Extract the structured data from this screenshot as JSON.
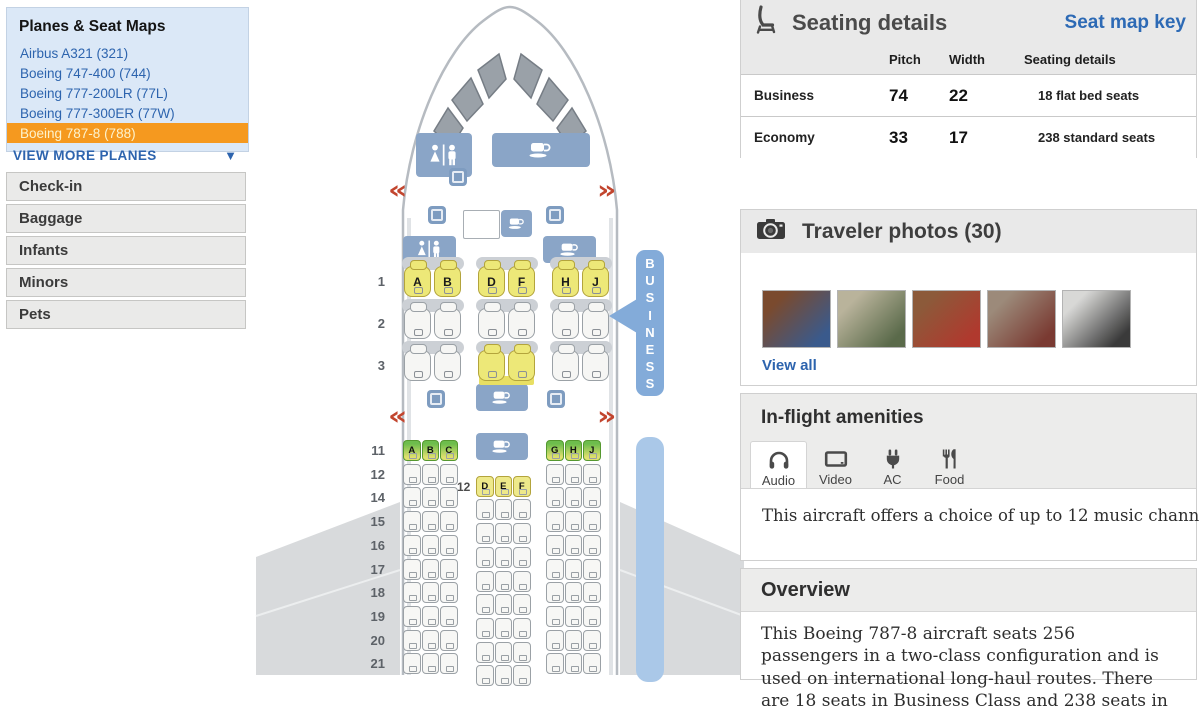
{
  "colors": {
    "accent_orange": "#f5991f",
    "link_blue": "#2d64ae",
    "panel_blue": "#8aa5c7",
    "arrow_blue": "#83abd9",
    "economy_bar_blue": "#aac8e8",
    "exit_red": "#c2452e",
    "seat_yellow": "#ede878",
    "seat_green": "#6dbd4c"
  },
  "sidebar": {
    "title": "Planes & Seat Maps",
    "planes": [
      {
        "label": "Airbus A321 (321)",
        "selected": false
      },
      {
        "label": "Boeing 747-400 (744)",
        "selected": false
      },
      {
        "label": "Boeing 777-200LR (77L)",
        "selected": false
      },
      {
        "label": "Boeing 777-300ER (77W)",
        "selected": false
      },
      {
        "label": "Boeing 787-8 (788)",
        "selected": true
      }
    ],
    "view_more": "VIEW MORE PLANES",
    "menu": [
      "Check-in",
      "Baggage",
      "Infants",
      "Minors",
      "Pets"
    ]
  },
  "seating_details": {
    "title": "Seating details",
    "key_link": "Seat map key",
    "columns": [
      "Pitch",
      "Width",
      "Seating details"
    ],
    "rows": [
      {
        "cabin": "Business",
        "pitch": "74",
        "width": "22",
        "details": "18 flat bed seats"
      },
      {
        "cabin": "Economy",
        "pitch": "33",
        "width": "17",
        "details": "238 standard seats"
      }
    ]
  },
  "traveler_photos": {
    "title": "Traveler photos (30)",
    "view_all": "View all",
    "photos": [
      {
        "c1": "#7a4a2e",
        "c2": "#3a5a8c"
      },
      {
        "c1": "#b9b39b",
        "c2": "#5a6a4a"
      },
      {
        "c1": "#8c5a3a",
        "c2": "#b0392e"
      },
      {
        "c1": "#9c8a7a",
        "c2": "#7a3a32"
      },
      {
        "c1": "#d8d8d6",
        "c2": "#3a3a3a"
      }
    ]
  },
  "amenities": {
    "title": "In-flight amenities",
    "tabs": [
      {
        "label": "Audio",
        "icon": "headphones",
        "selected": true
      },
      {
        "label": "Video",
        "icon": "video",
        "selected": false
      },
      {
        "label": "AC Power",
        "icon": "ac-power",
        "selected": false
      },
      {
        "label": "Food",
        "icon": "food",
        "selected": false
      }
    ],
    "description": "This aircraft offers a choice of up to 12 music channels."
  },
  "overview": {
    "title": "Overview",
    "text": "This Boeing 787-8 aircraft seats 256 passengers in a two-class configuration and is used on international long-haul routes. There are 18 seats in Business Class and 238 seats in"
  },
  "seatmap": {
    "business_label": "BUSINESS",
    "exit_left": "«",
    "exit_right": "»",
    "business_rows": [
      {
        "num": "1",
        "pairs": [
          {
            "letters": [
              "A",
              "B"
            ],
            "color": "yellow"
          },
          {
            "letters": [
              "D",
              "F"
            ],
            "color": "yellow"
          },
          {
            "letters": [
              "H",
              "J"
            ],
            "color": "yellow"
          }
        ]
      },
      {
        "num": "2",
        "pairs": [
          {
            "letters": [
              null,
              null
            ],
            "color": "white"
          },
          {
            "letters": [
              null,
              null
            ],
            "color": "white"
          },
          {
            "letters": [
              null,
              null
            ],
            "color": "white"
          }
        ]
      },
      {
        "num": "3",
        "pairs": [
          {
            "letters": [
              null,
              null
            ],
            "color": "white"
          },
          {
            "letters": [
              null,
              null
            ],
            "color": "yellow"
          },
          {
            "letters": [
              null,
              null
            ],
            "color": "white"
          }
        ]
      }
    ],
    "economy_rows": [
      {
        "num": "11",
        "left": {
          "letters": [
            "A",
            "B",
            "C"
          ],
          "color": "green"
        },
        "right": {
          "letters": [
            "G",
            "H",
            "J"
          ],
          "color": "green"
        },
        "mid": "galley"
      },
      {
        "num": "12",
        "mid": {
          "label": "12",
          "letters": [
            "D",
            "E",
            "F"
          ],
          "color": "yellow"
        }
      },
      {
        "num": "14"
      },
      {
        "num": "15"
      },
      {
        "num": "16"
      },
      {
        "num": "17"
      },
      {
        "num": "18"
      },
      {
        "num": "19"
      },
      {
        "num": "20"
      },
      {
        "num": "21"
      }
    ]
  }
}
